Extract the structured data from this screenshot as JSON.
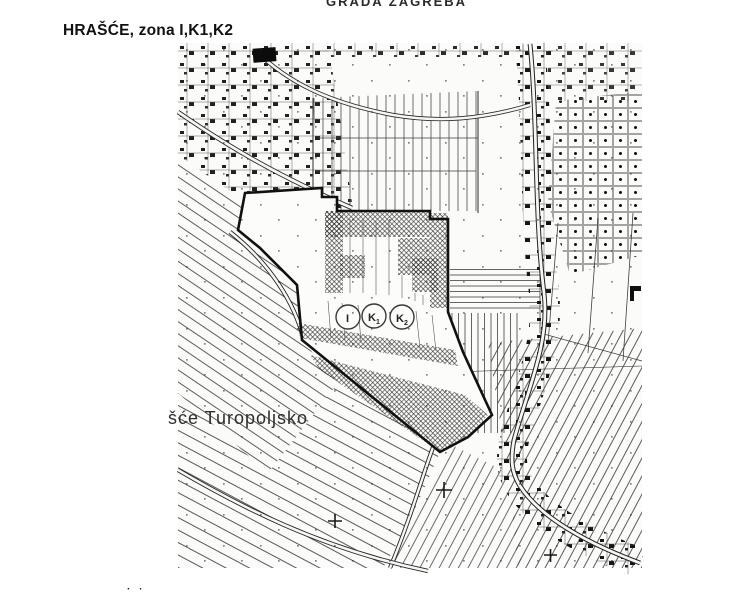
{
  "header": {
    "org_line": "GRADA ZAGREBA"
  },
  "title": {
    "text": "HRAŠĆE, zona I,K1,K2"
  },
  "map": {
    "place_label": "šće Turopoljsko",
    "zone_circles": [
      {
        "label": "I",
        "sub": ""
      },
      {
        "label": "K",
        "sub": "1"
      },
      {
        "label": "K",
        "sub": "2"
      }
    ],
    "colors": {
      "ink": "#1f1f1f",
      "paper": "#fbfbf9",
      "hatch": "#2a2a2a"
    }
  },
  "bottom": {
    "artifact": "· ·"
  }
}
